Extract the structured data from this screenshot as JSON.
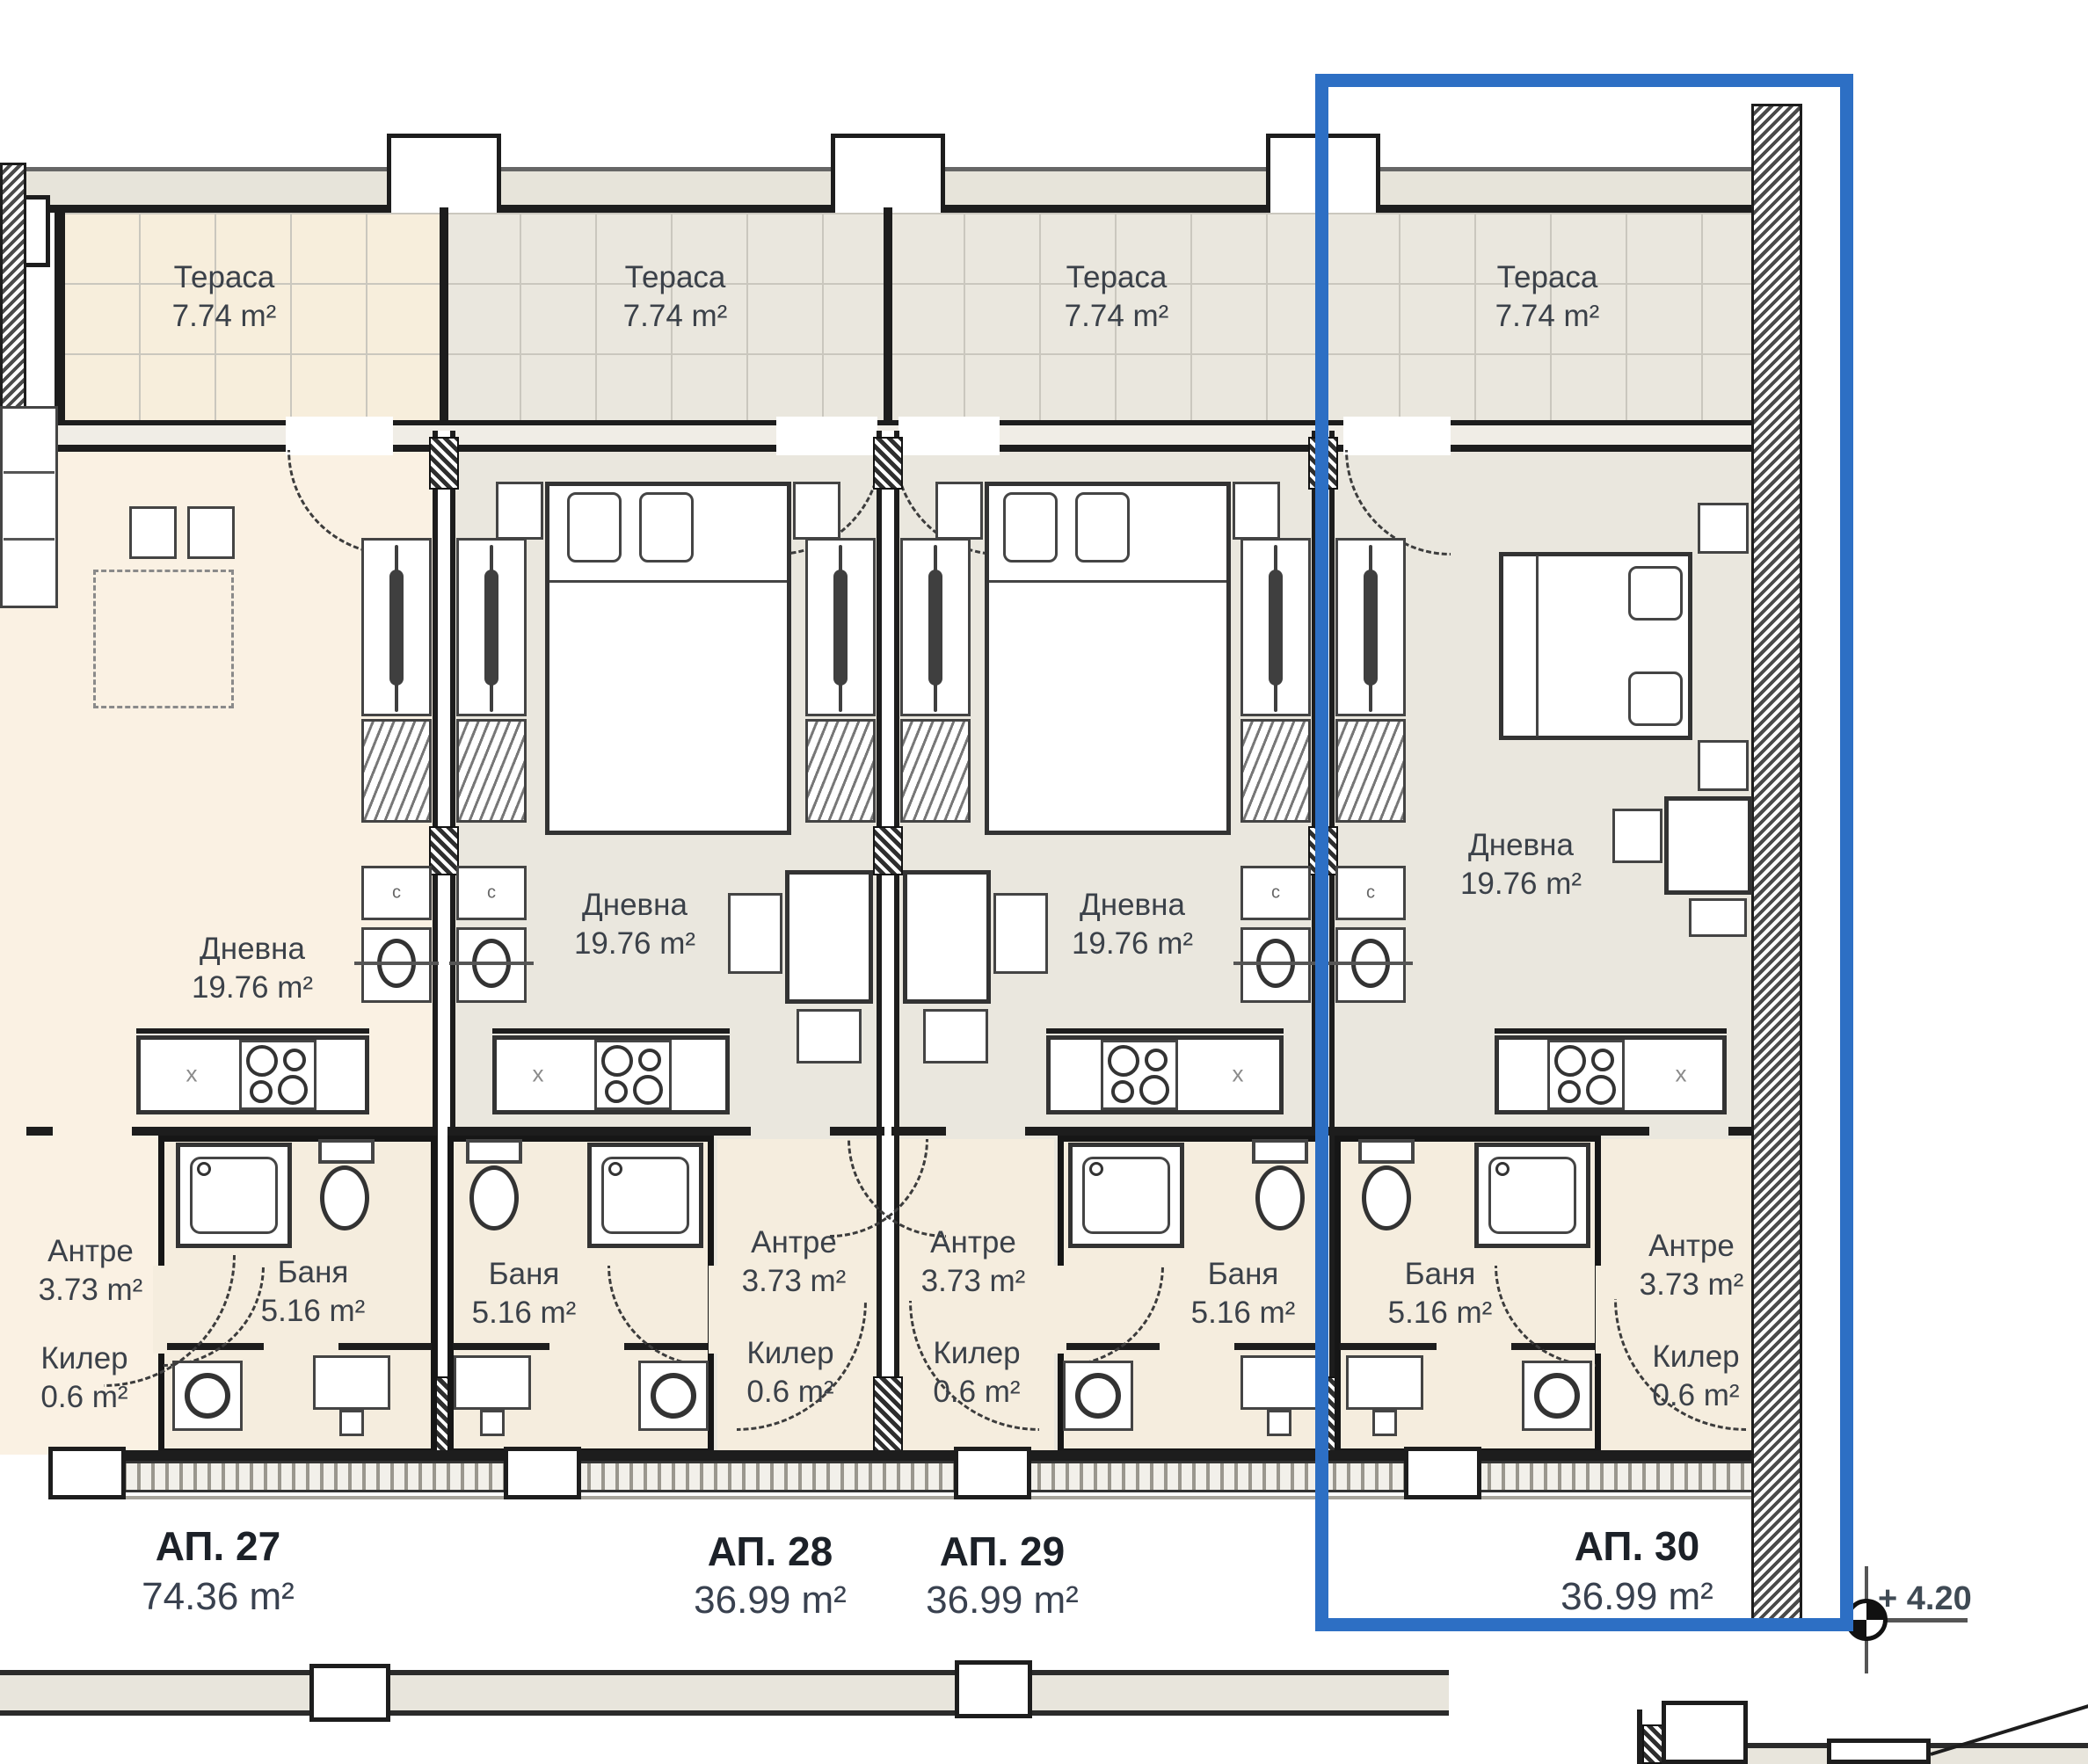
{
  "terraces": [
    {
      "name": "Тераса",
      "area": "7.74 m²"
    },
    {
      "name": "Тераса",
      "area": "7.74 m²"
    },
    {
      "name": "Тераса",
      "area": "7.74 m²"
    },
    {
      "name": "Тераса",
      "area": "7.74 m²"
    }
  ],
  "apartments": [
    {
      "label": "АП. 27",
      "total_area": "74.36 m²",
      "living_name": "Дневна",
      "living_area": "19.76 m²",
      "entry_name": "Антре",
      "entry_area": "3.73 m²",
      "bath_name": "Баня",
      "bath_area": "5.16 m²",
      "closet_name": "Килер",
      "closet_area": "0.6 m²"
    },
    {
      "label": "АП. 28",
      "total_area": "36.99 m²",
      "living_name": "Дневна",
      "living_area": "19.76 m²",
      "entry_name": "Антре",
      "entry_area": "3.73 m²",
      "bath_name": "Баня",
      "bath_area": "5.16 m²",
      "closet_name": "Килер",
      "closet_area": "0.6 m²"
    },
    {
      "label": "АП. 29",
      "total_area": "36.99 m²",
      "living_name": "Дневна",
      "living_area": "19.76 m²",
      "entry_name": "Антре",
      "entry_area": "3.73 m²",
      "bath_name": "Баня",
      "bath_area": "5.16 m²",
      "closet_name": "Килер",
      "closet_area": "0.6 m²"
    },
    {
      "label": "АП. 30",
      "total_area": "36.99 m²",
      "living_name": "Дневна",
      "living_area": "19.76 m²",
      "entry_name": "Антре",
      "entry_area": "3.73 m²",
      "bath_name": "Баня",
      "bath_area": "5.16 m²",
      "closet_name": "Килер",
      "closet_area": "0.6 m²"
    }
  ],
  "elevation": "+ 4.20",
  "marks": {
    "sink": "x",
    "cabinet": "c"
  },
  "colors": {
    "highlight": "#2d6fc4",
    "apt27_fill": "#faf1e3",
    "unit_fill": "#eae7de",
    "terrace_cream": "#f7eedc",
    "bath_fill": "#f5edde",
    "wall": "#1d1d1d"
  }
}
